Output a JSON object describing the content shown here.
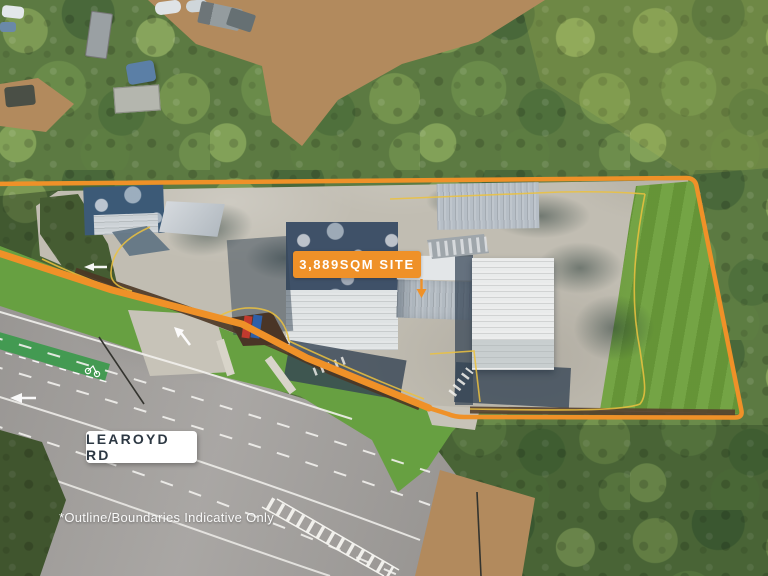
{
  "annotations": {
    "site_label": "3,889SQM SITE",
    "road_label": "LEAROYD RD",
    "disclaimer": "*Outline/Boundaries Indicative Only"
  },
  "colors": {
    "boundary_orange": "#EF9128",
    "site_label_bg": "#EF9128",
    "site_label_text": "#FFFFFF",
    "road_pill_bg": "#FFFFFF",
    "road_pill_text": "#2D3843",
    "disclaimer_text": "#FFFFFF",
    "lawn_green": "#6D9F3B",
    "bike_lane_green": "#3C9A4C",
    "yellow_curb_line": "#ECC23F"
  }
}
